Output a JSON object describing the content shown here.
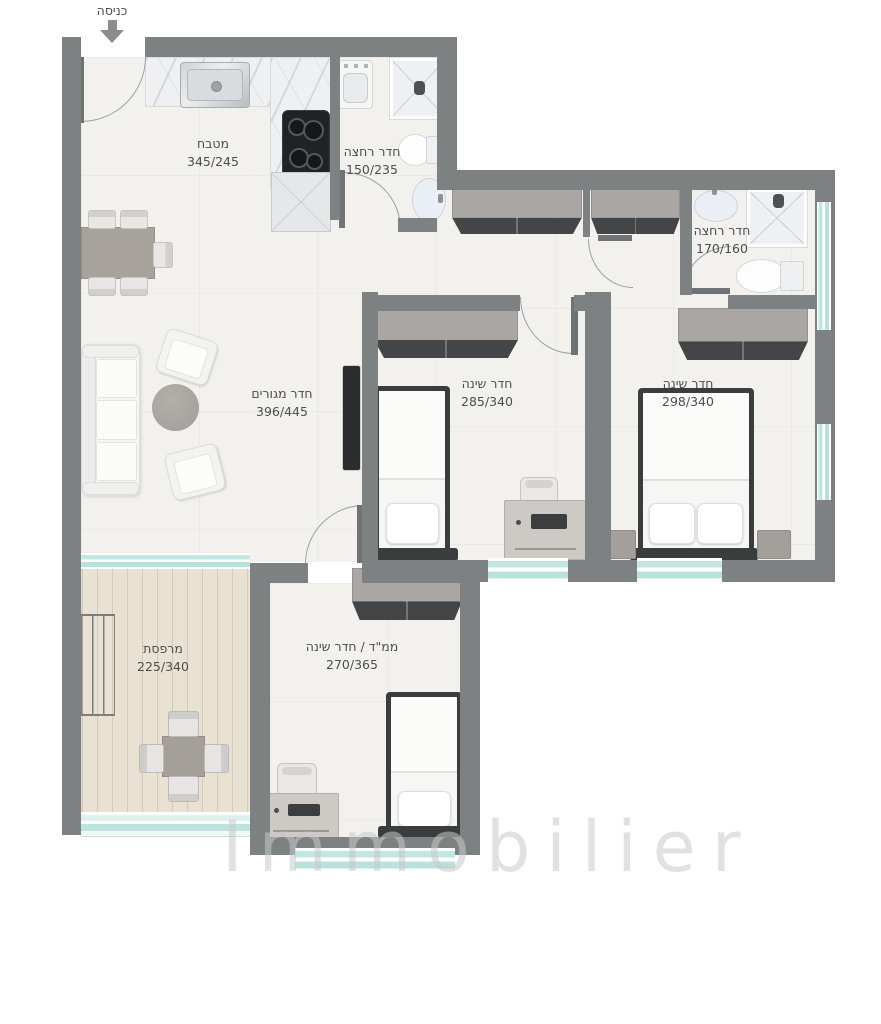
{
  "entrance": {
    "label": "כניסה"
  },
  "rooms": {
    "kitchen": {
      "name": "מטבח",
      "dims": "345/245"
    },
    "bath1": {
      "name": "חדר רחצה",
      "dims": "150/235"
    },
    "bath2": {
      "name": "חדר רחצה",
      "dims": "170/160"
    },
    "living": {
      "name": "חדר מגורים",
      "dims": "396/445"
    },
    "bedroom1": {
      "name": "חדר שינה",
      "dims": "285/340"
    },
    "bedroom2": {
      "name": "חדר שינה",
      "dims": "298/340"
    },
    "balcony": {
      "name": "מרפסת",
      "dims": "225/340"
    },
    "saferoom": {
      "name": "ממ\"ד / חדר שינה",
      "dims": "270/365"
    }
  },
  "watermark": "Immobilier",
  "colors": {
    "wall": "#7d8182",
    "floor": "#f2f1ee",
    "balcony_floor": "#e9e2d3",
    "window": "#c2e7e2",
    "label_text": "#4b4e50"
  }
}
